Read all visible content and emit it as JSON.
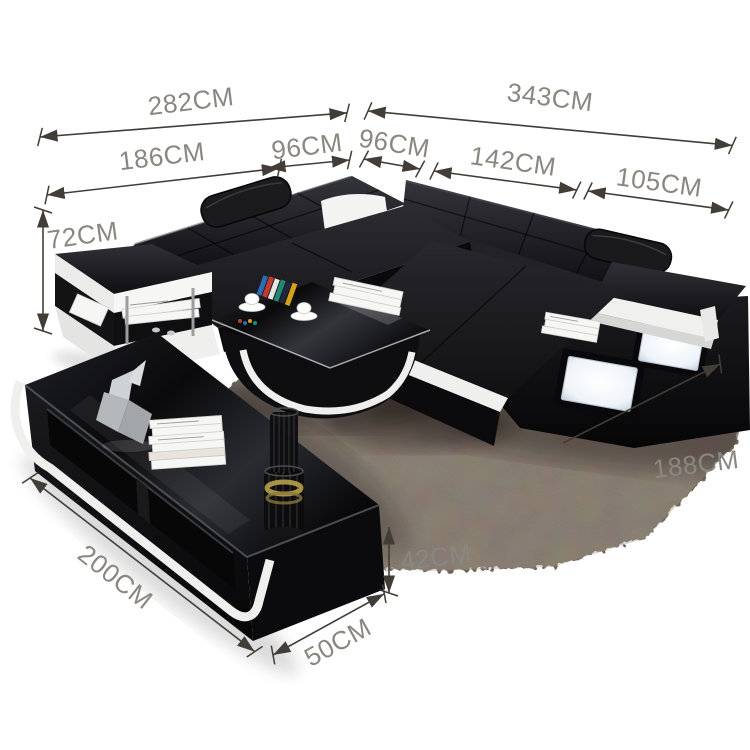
{
  "image": {
    "kind": "furniture-product-dimension-diagram",
    "subject": "black leather U-shaped sectional sofa set with coffee table and TV stand on shag rug"
  },
  "colors": {
    "background": "#ffffff",
    "leather_black": "#141417",
    "accent_white": "#efefed",
    "rug_brown": "#6f6458",
    "panel_glow": "#eef3f9",
    "pillow_white": "#f3f3f1",
    "dimension_text": "#8b8680",
    "dimension_line": "#423d37"
  },
  "dimensions": {
    "sofa_left_overall": {
      "label": "282CM",
      "value_cm": 282
    },
    "sofa_right_overall": {
      "label": "343CM",
      "value_cm": 343
    },
    "left_arm_section": {
      "label": "186CM",
      "value_cm": 186
    },
    "left_corner_section": {
      "label": "96CM",
      "value_cm": 96
    },
    "right_corner_section": {
      "label": "96CM",
      "value_cm": 96
    },
    "right_mid_section": {
      "label": "142CM",
      "value_cm": 142
    },
    "chaise_section": {
      "label": "105CM",
      "value_cm": 105
    },
    "sofa_height": {
      "label": "72CM",
      "value_cm": 72
    },
    "sofa_depth": {
      "label": "188CM",
      "value_cm": 188
    },
    "tv_stand_length": {
      "label": "200CM",
      "value_cm": 200
    },
    "tv_stand_depth": {
      "label": "50CM",
      "value_cm": 50
    },
    "tv_stand_height": {
      "label": "42CM",
      "value_cm": 42
    }
  },
  "scene": {
    "furniture": [
      "sectional-sofa",
      "coffee-table",
      "tv-stand",
      "area-rug"
    ],
    "decor": [
      "white-pillow",
      "headrests",
      "led-panels",
      "magazines",
      "coffee-cups",
      "books",
      "sculpture",
      "wire-vase"
    ]
  }
}
